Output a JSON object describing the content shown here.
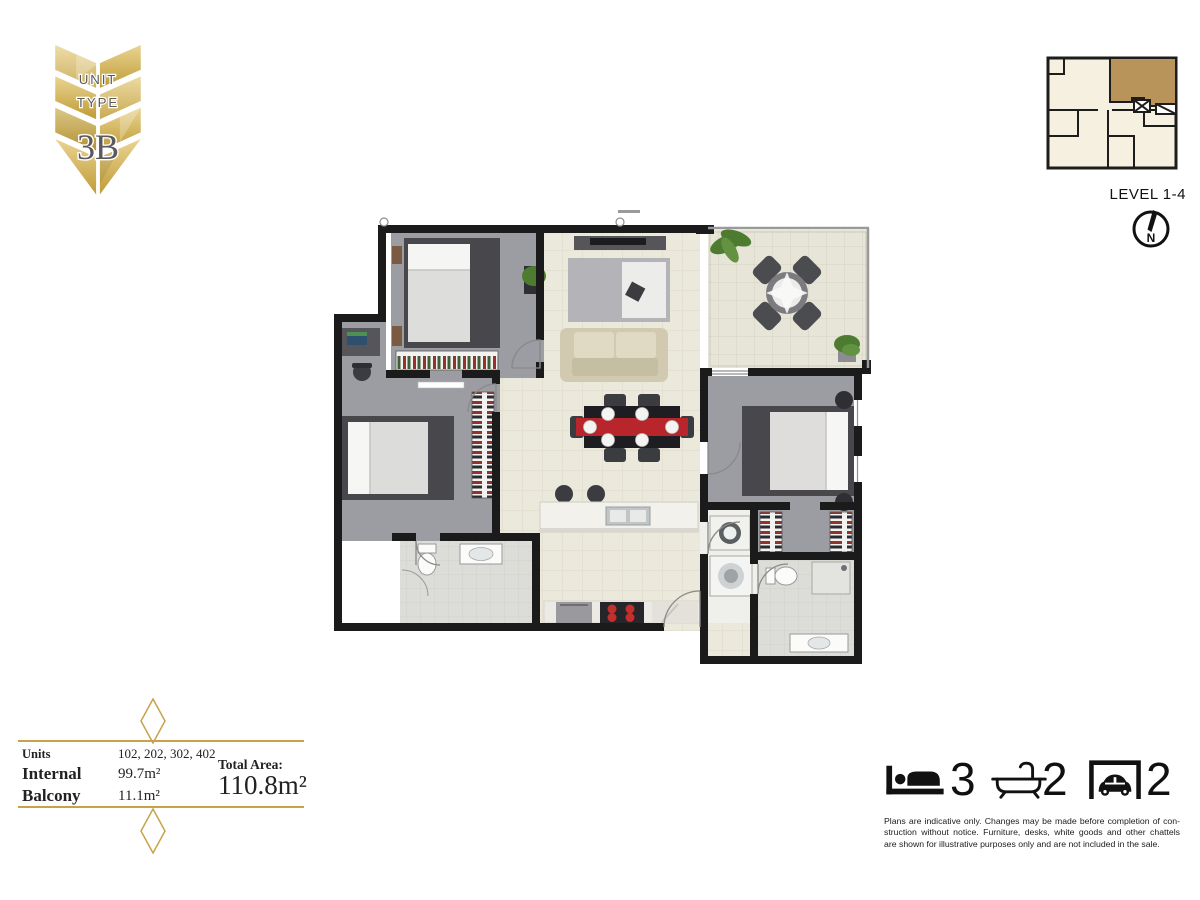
{
  "page": {
    "background": "#ffffff"
  },
  "badge": {
    "line1": "UNIT",
    "line2": "TYPE",
    "code": "3B",
    "gold_light": "#e9d492",
    "gold_dark": "#bf9a33",
    "text_color": "#5a5a5c"
  },
  "level_plan": {
    "label": "LEVEL 1-4",
    "compass_letter": "N",
    "highlight_color": "#b8935a",
    "floor_color": "#f6f0e1",
    "wall_color": "#1d1d1b"
  },
  "floor_plan": {
    "colors": {
      "wall": "#1b1b1b",
      "carpet": "#9c9ca3",
      "tile": "#ebe8dc",
      "balcony_tile": "#e7e5d7",
      "accent_red": "#b8262b",
      "sofa": "#d2cab0"
    },
    "rooms": [
      "bedroom-1",
      "bedroom-2",
      "bedroom-3",
      "study-nook",
      "living-dining",
      "kitchen",
      "balcony",
      "bathroom",
      "ensuite",
      "laundry",
      "walk-in-robe"
    ]
  },
  "area_table": {
    "rows": [
      {
        "label": "Units",
        "value": "102, 202, 302, 402"
      },
      {
        "label": "Internal",
        "value": "99.7m²"
      },
      {
        "label": "Balcony",
        "value": "11.1m²"
      }
    ],
    "total_label": "Total Area:",
    "total_value": "110.8m²",
    "accent": "#c8a24b"
  },
  "features": [
    {
      "name": "bedrooms",
      "count": "3"
    },
    {
      "name": "bathrooms",
      "count": "2"
    },
    {
      "name": "car-spaces",
      "count": "2"
    }
  ],
  "disclaimer": {
    "lines": [
      "Plans are indicative only. Changes may be made before completion of con-",
      "struction without notice. Furniture, desks, white goods and other chattels",
      "are shown for illustrative purposes only and are not included in the sale."
    ]
  }
}
